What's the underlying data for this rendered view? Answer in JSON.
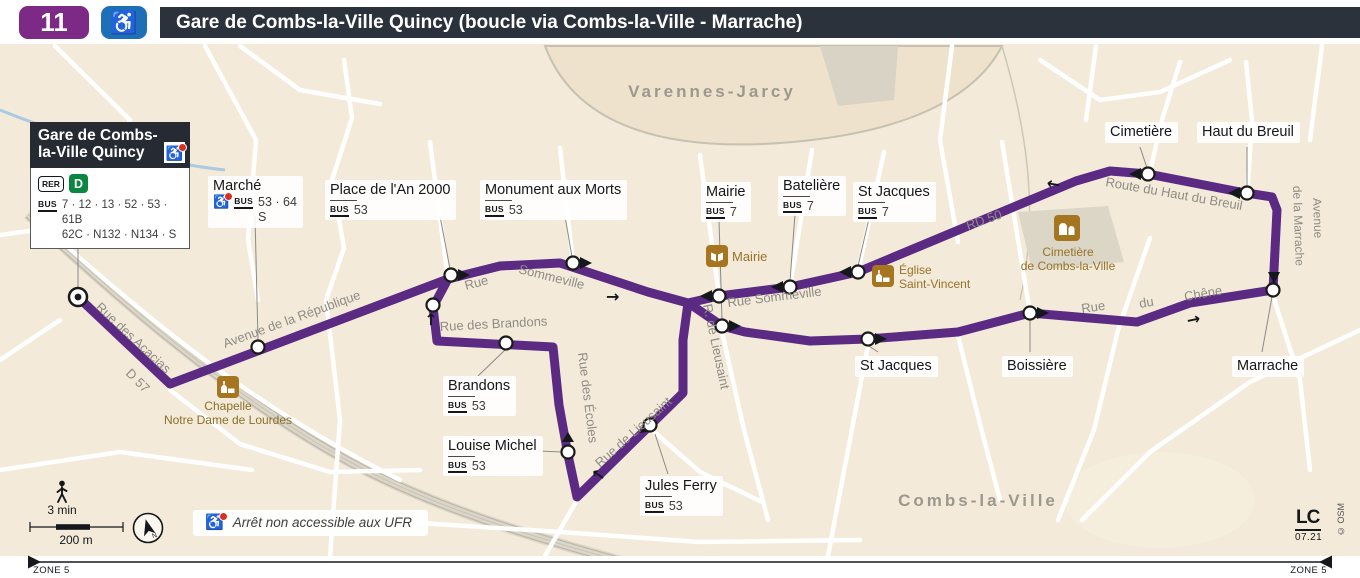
{
  "header": {
    "line_number": "11",
    "title": "Gare de Combs-la-Ville Quincy (boucle via Combs-la-Ville - Marrache)",
    "accessibility_icon": "wheelchair-icon"
  },
  "terminus": {
    "name_line1": "Gare de Combs-",
    "name_line2": "la-Ville Quincy",
    "rer": "RER",
    "rer_line": "D",
    "bus": "BUS",
    "lines1": "7 · 12 · 13 · 52 · 53 · 61B",
    "lines2": "62C · N132 · N134 · S"
  },
  "stops": {
    "marche": {
      "name": "Marché",
      "bus": "BUS",
      "lines1": "53 · 64",
      "lines2": "S"
    },
    "place_an_2000": {
      "name": "Place de l'An 2000",
      "bus": "BUS",
      "lines": "53"
    },
    "monument_aux_morts": {
      "name": "Monument aux Morts",
      "bus": "BUS",
      "lines": "53"
    },
    "mairie": {
      "name": "Mairie",
      "bus": "BUS",
      "lines": "7"
    },
    "bateliere": {
      "name": "Batelière",
      "bus": "BUS",
      "lines": "7"
    },
    "st_jacques_nord": {
      "name": "St Jacques",
      "bus": "BUS",
      "lines": "7"
    },
    "cimetiere": {
      "name": "Cimetière"
    },
    "haut_du_breuil": {
      "name": "Haut du Breuil"
    },
    "marrache": {
      "name": "Marrache"
    },
    "boissiere": {
      "name": "Boissière"
    },
    "st_jacques_sud": {
      "name": "St Jacques"
    },
    "brandons": {
      "name": "Brandons",
      "bus": "BUS",
      "lines": "53"
    },
    "louise_michel": {
      "name": "Louise Michel",
      "bus": "BUS",
      "lines": "53"
    },
    "jules_ferry": {
      "name": "Jules Ferry",
      "bus": "BUS",
      "lines": "53"
    }
  },
  "streets": {
    "acacias": "Rue des Acacias",
    "d57": "D 57",
    "republique": "Avenue de la République",
    "rue": "Rue",
    "sommeville": "Sommeville",
    "rue_sommeville": "Rue Sommeville",
    "rue_des_brandons": "Rue des Brandons",
    "rue_des_ecoles": "Rue des Écoles",
    "r_de_lieusaint": "R. de Lieusaint",
    "rue_de_lieusaint": "Rue de Lieusaint",
    "rd50": "RD 50",
    "route_haut_breuil": "Route du Haut du Breuil",
    "avenue": "Avenue",
    "de_la_marrache": "de la Marrache",
    "rue_2": "Rue",
    "du": "du",
    "chene": "Chêne"
  },
  "areas": {
    "north": "Varennes-Jarcy",
    "south": "Combs-la-Ville"
  },
  "pois": {
    "chapelle": {
      "line1": "Chapelle",
      "line2": "Notre Dame de Lourdes"
    },
    "mairie": {
      "name": "Mairie"
    },
    "eglise": {
      "line1": "Église",
      "line2": "Saint-Vincent"
    },
    "cimetiere": {
      "line1": "Cimetière",
      "line2": "de Combs-la-Ville"
    }
  },
  "legend": {
    "ufr": "Arrêt non accessible aux UFR",
    "walk_time": "3 min",
    "walk_dist": "200 m",
    "compass": "N"
  },
  "footer": {
    "zone_left": "ZONE 5",
    "zone_right": "ZONE 5"
  },
  "credits": {
    "logo": "LC",
    "date": "07.21",
    "osm": "© OSM"
  },
  "colors": {
    "route_purple": "#5b2a82",
    "line_badge_purple": "#7d2a86",
    "accessible_blue": "#1d70b7",
    "titlebar_dark": "#2b323c",
    "map_beige": "#f3ead9",
    "rer_d_green": "#0c8540",
    "poi_brown": "#a5751f",
    "no_entry_red": "#d93025"
  }
}
